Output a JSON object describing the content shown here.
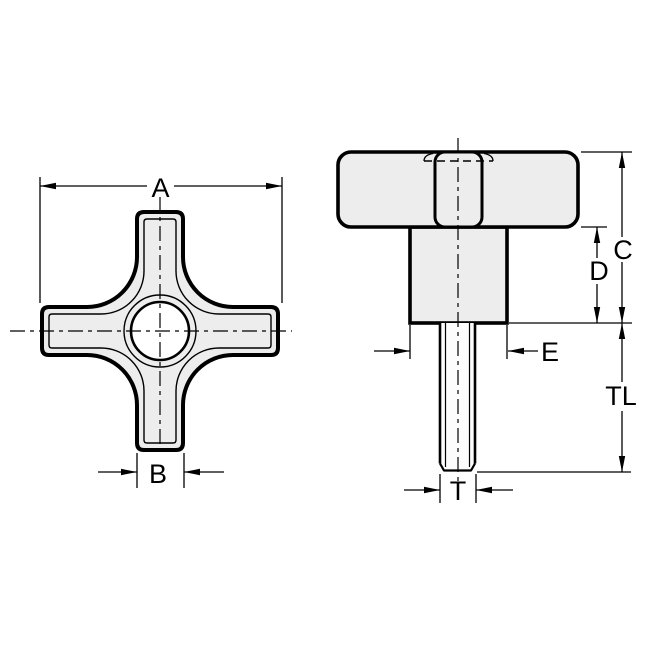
{
  "page": {
    "background_color": "#ffffff",
    "line_color": "#000000",
    "part_fill_color": "#ededed"
  },
  "views": {
    "front": {
      "dimension_labels": {
        "overall_width": "A",
        "arm_width": "B"
      }
    },
    "side": {
      "dimension_labels": {
        "overall_height": "C",
        "hub_height": "D",
        "hub_diameter": "E",
        "thread_length": "TL",
        "thread_diameter": "T"
      }
    }
  }
}
